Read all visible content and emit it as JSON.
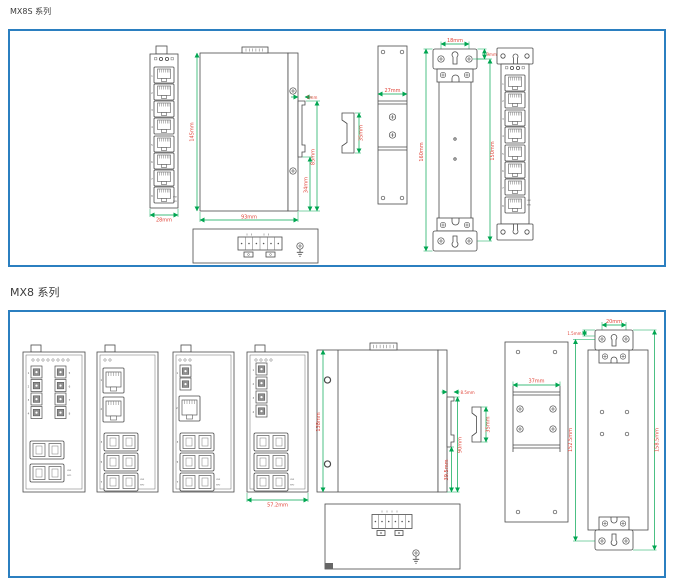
{
  "page": {
    "sections": [
      {
        "title": "MX8S 系列"
      },
      {
        "title": "MX8 系列"
      }
    ]
  },
  "colors": {
    "panel_border": "#2b7fc0",
    "dimension_line": "#00a651",
    "dimension_text": "#e04438",
    "drawing_line": "#4a4a4a"
  },
  "mx8s": {
    "ports": [
      "1",
      "2",
      "3",
      "4",
      "5",
      "6",
      "7",
      "8"
    ],
    "port_status": [
      "LNK",
      "SPD"
    ],
    "dims": {
      "front_width": "28mm",
      "height": "145mm",
      "depth": "93mm",
      "din_clip_tab": "5mm",
      "din_clip_to_bottom": "85mm",
      "din_hook_to_bottom": "34mm",
      "din_rail_profile": "35mm",
      "rear_plate_width": "27mm",
      "bracket_hole_spacing": "18mm",
      "bracket_hole_offset": "9mm",
      "mount_overall_height": "160mm",
      "mount_hole_height": "150mm"
    }
  },
  "mx8": {
    "ports": [
      "1",
      "2",
      "3",
      "4",
      "5",
      "6",
      "7",
      "8"
    ],
    "port_status": [
      "LNK",
      "SPD"
    ],
    "dims": {
      "front_width": "57.2mm",
      "height": "138mm",
      "din_clip_tab": "8.5mm",
      "din_clip_to_bottom": "90mm",
      "din_hook_to_bottom": "39.5mm",
      "din_rail_profile": "35mm",
      "rear_plate_width": "37mm",
      "bracket_hole_spacing": "20mm",
      "bracket_hole_offset": "1.5mm",
      "mount_hole_height": "152.5mm",
      "mount_overall_height": "158.5mm"
    }
  }
}
